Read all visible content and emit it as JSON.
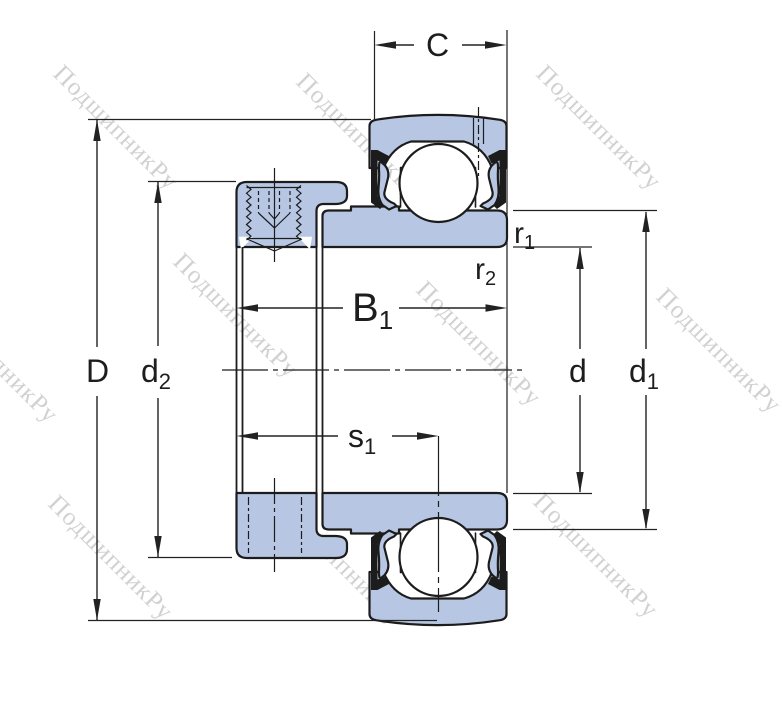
{
  "watermark": {
    "text": "ПодшипникРу",
    "color": "#c6c6c6"
  },
  "drawing": {
    "fill": "#b7c7e3",
    "line_color": "#1c1c1c",
    "background": "#ffffff"
  },
  "dimensions": {
    "C": {
      "label": "C"
    },
    "D": {
      "label": "D"
    },
    "d2": {
      "label": "d",
      "sub": "2"
    },
    "B1": {
      "label": "B",
      "sub": "1"
    },
    "s1": {
      "label": "s",
      "sub": "1"
    },
    "r1": {
      "label": "r",
      "sub": "1"
    },
    "r2": {
      "label": "r",
      "sub": "2"
    },
    "d": {
      "label": "d"
    },
    "d1": {
      "label": "d",
      "sub": "1"
    }
  }
}
